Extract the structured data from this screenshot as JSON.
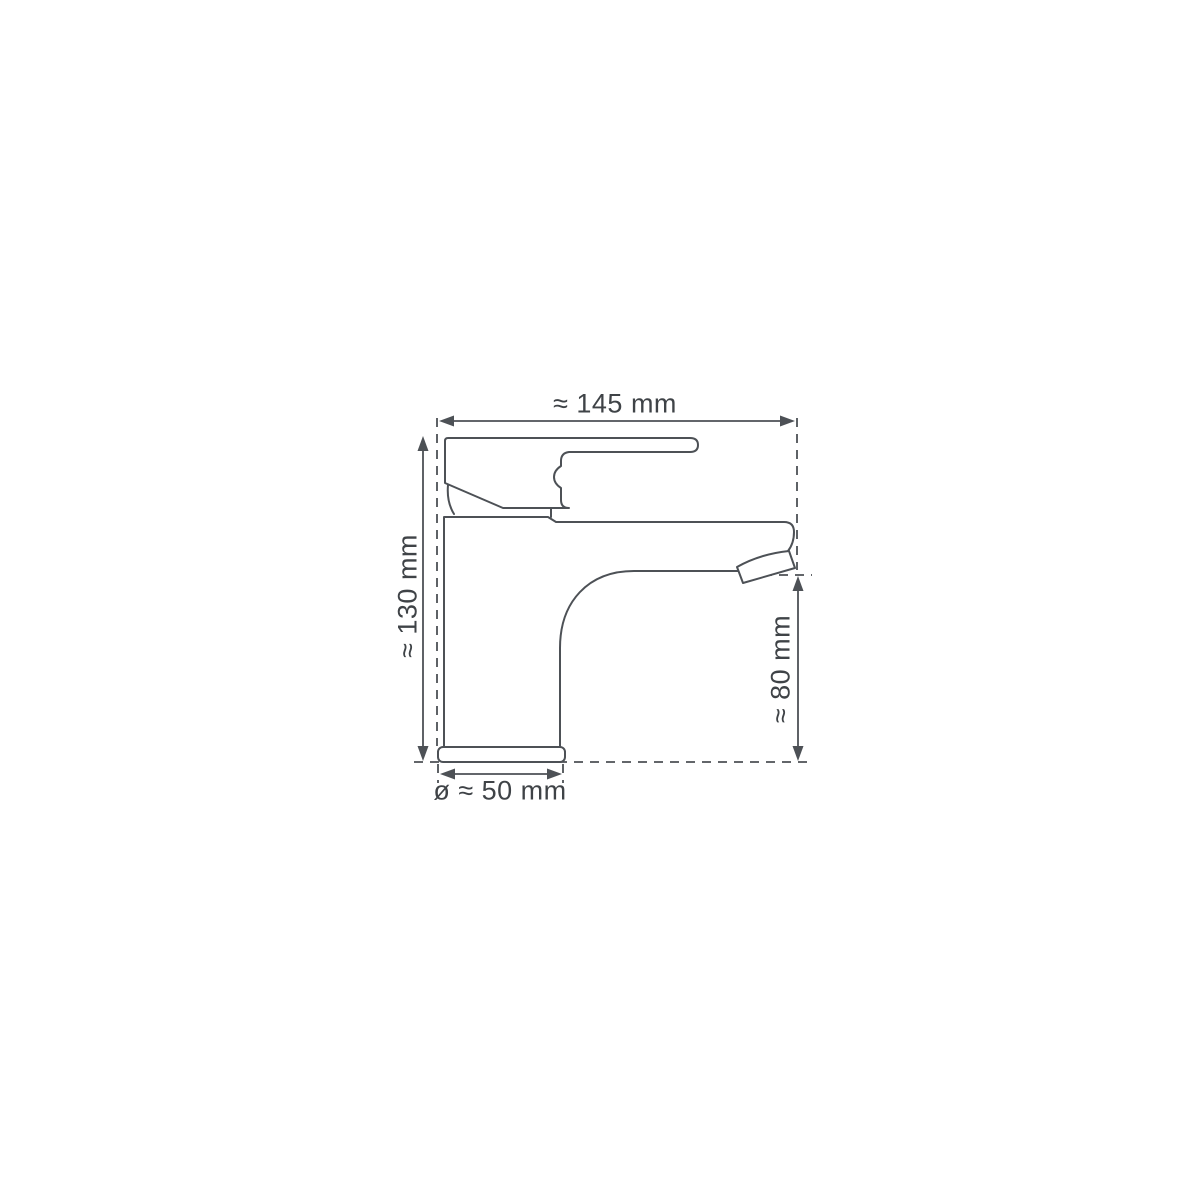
{
  "diagram": {
    "type": "technical-drawing",
    "subject": "basin mixer tap side view with dimensions",
    "labels": {
      "width": "≈ 145 mm",
      "height": "≈ 130 mm",
      "spout_height": "≈ 80 mm",
      "base_diameter": "ø ≈ 50 mm"
    },
    "measurements": {
      "approximate": true,
      "width_mm": 145,
      "height_mm": 130,
      "spout_height_mm": 80,
      "base_diameter_mm": 50
    },
    "colors": {
      "background": "#ffffff",
      "line": "#4d5156",
      "text": "#3f4347"
    }
  }
}
